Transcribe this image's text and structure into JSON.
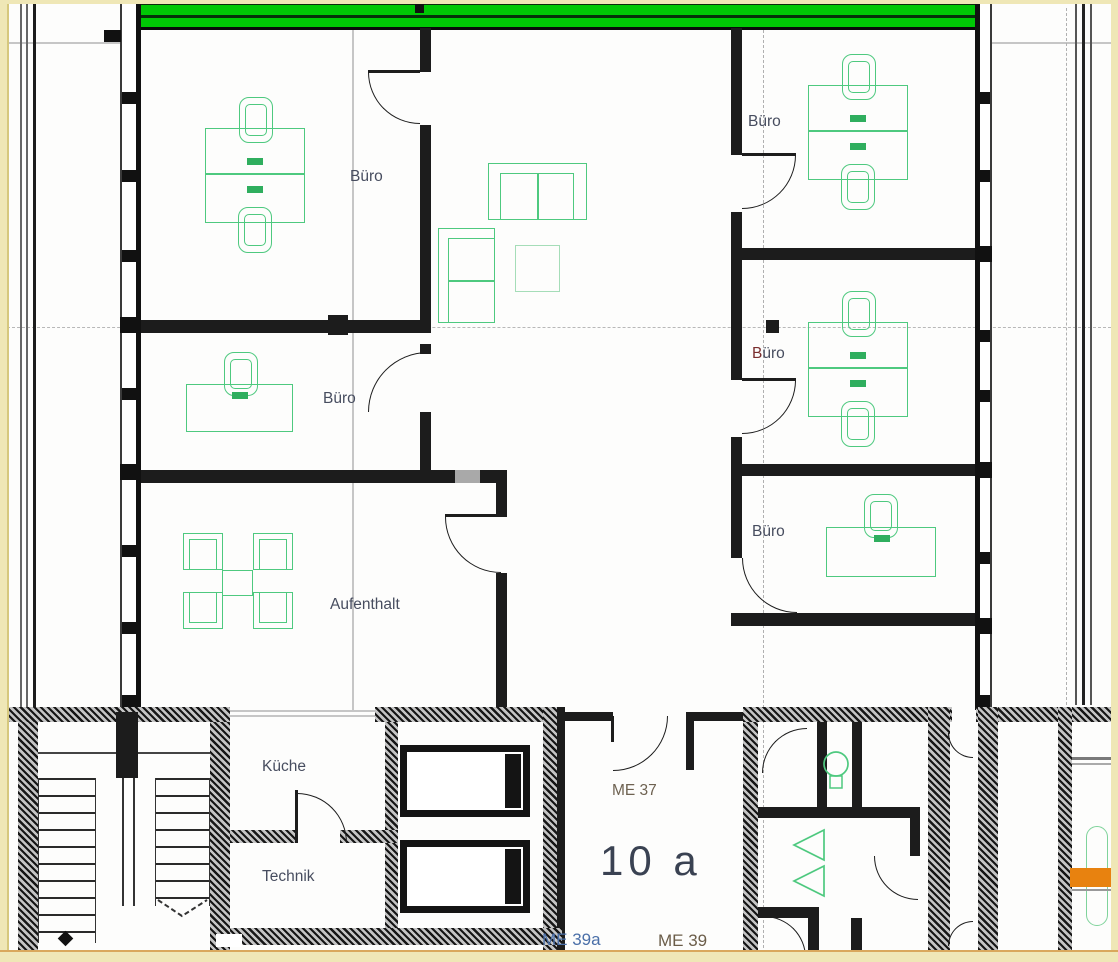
{
  "plan": {
    "title": "Grundriss Obergeschoss (Büroetage)",
    "rooms": {
      "buero_top_left": "Büro",
      "buero_mid_left": "Büro",
      "buero_right_1": "Büro",
      "buero_right_2": "Büro",
      "buero_right_3": "Büro",
      "aufenthalt": "Aufenthalt",
      "kueche": "Küche",
      "technik": "Technik"
    },
    "units": {
      "me37": "ME 37",
      "main": "10 a",
      "me39a": "ME 39a",
      "me39": "ME 39"
    },
    "colors": {
      "facade_green": "#00c805",
      "furniture_green": "#4ec97f",
      "furniture_green_light": "#a5ddb8",
      "accent_orange": "#e8820f",
      "sheet_border_cream": "#efe7b6",
      "wall_black": "#1c1c1c",
      "label_dark": "#474d5f",
      "label_red_accent": "#7a2e2e",
      "label_blue": "#4a6fa8",
      "label_brown": "#6e6251"
    },
    "symbols": {
      "desk": "desk",
      "office_chair": "office-chair",
      "sofa": "sofa",
      "coffee_table": "coffee-table",
      "meeting_table": "meeting-table",
      "washbasin": "washbasin",
      "urinal": "urinal",
      "radiator": "radiator",
      "stairs": "stairs",
      "elevator": "elevator",
      "door_swing": "door-swing"
    }
  }
}
